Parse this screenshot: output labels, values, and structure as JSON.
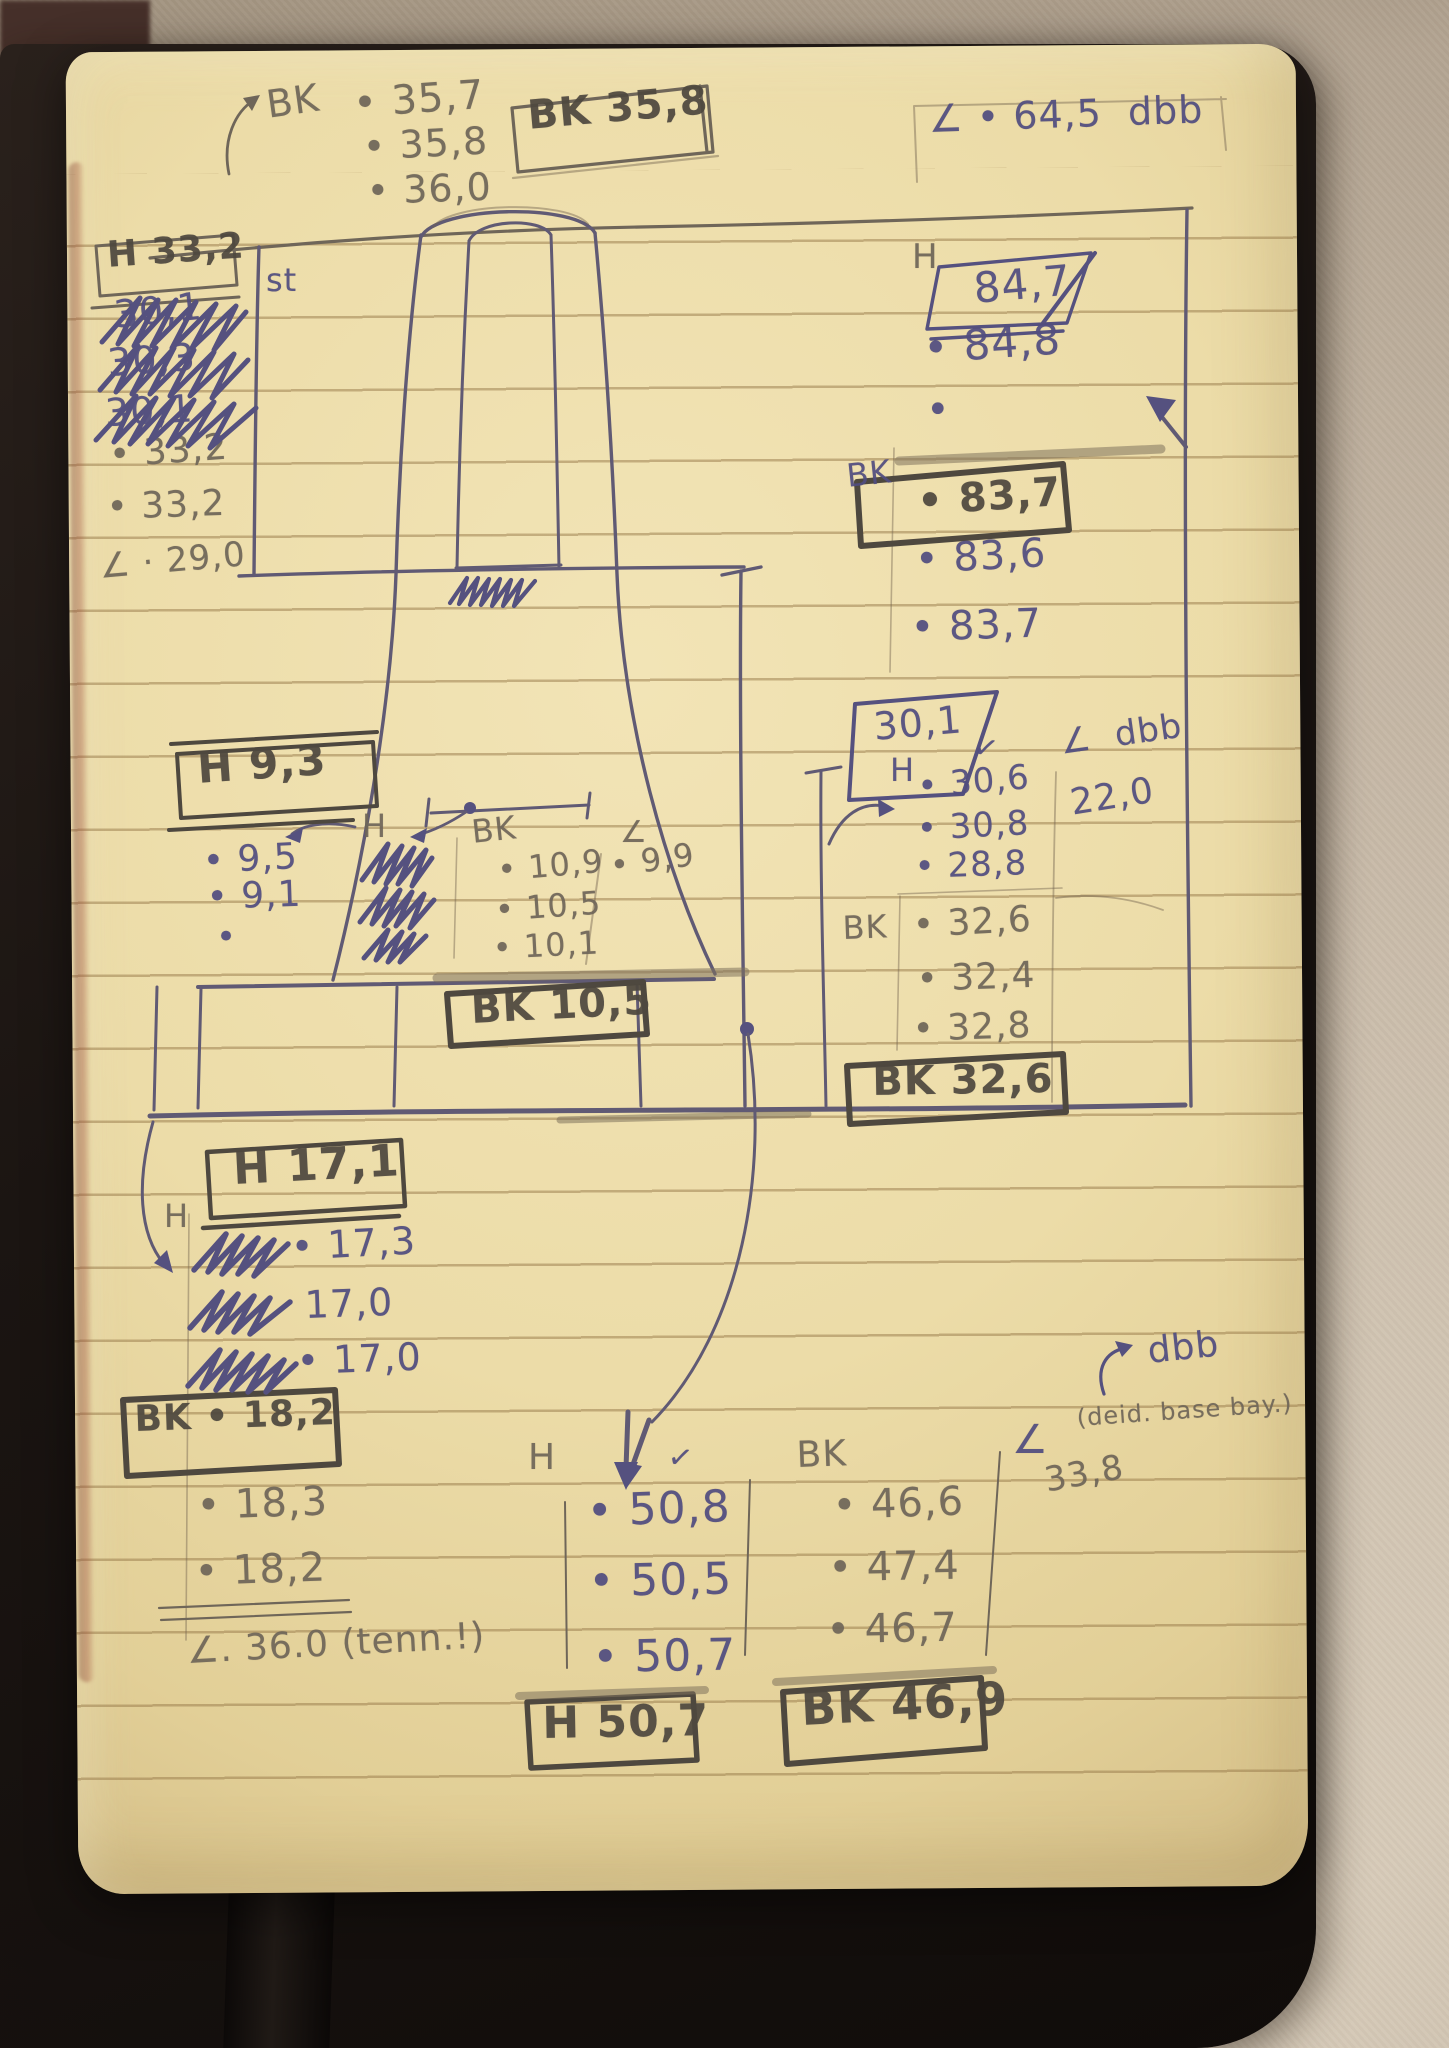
{
  "meta": {
    "description": "Photograph of a notebook page with hand-written field measurements (H and BK value series, angle readings) around a sketched monument / obelisk"
  },
  "colors": {
    "page_paper": "#ecddab",
    "ruled_line": "#9b7c4a",
    "pencil": "#6f6659",
    "ink_blue": "#514d80",
    "heavy_pencil": "#4e483f",
    "cover": "#1b1512",
    "wall": "#c3b5a2",
    "ribbon": "#15100d"
  },
  "annotations": [
    {
      "name": "bk-top-label",
      "text": "BK",
      "x": 264,
      "y": 86,
      "s": 38,
      "c": "p",
      "r": -8
    },
    {
      "name": "bk-top-value-1",
      "text": "• 35,7",
      "x": 352,
      "y": 84,
      "s": 40,
      "c": "p",
      "r": -4
    },
    {
      "name": "bk-top-value-2",
      "text": "• 35,8",
      "x": 362,
      "y": 128,
      "s": 38,
      "c": "p",
      "r": -3
    },
    {
      "name": "bk-top-value-3",
      "text": "• 36,0",
      "x": 366,
      "y": 172,
      "s": 38,
      "c": "p",
      "r": -2
    },
    {
      "name": "bk-top-result-box",
      "text": "BK 35,8",
      "x": 526,
      "y": 96,
      "s": 40,
      "c": "h",
      "r": -5
    },
    {
      "name": "angle-top-right",
      "text": "∠ • 64,5  dbb",
      "x": 928,
      "y": 100,
      "s": 38,
      "c": "i",
      "r": -2
    },
    {
      "name": "h-left-result-box",
      "text": "H 33,2",
      "x": 106,
      "y": 238,
      "s": 36,
      "c": "h",
      "r": -4
    },
    {
      "name": "h-left-struck-1",
      "text": "30,1",
      "x": 112,
      "y": 296,
      "s": 38,
      "c": "i",
      "r": -6
    },
    {
      "name": "h-left-struck-2",
      "text": "30,3",
      "x": 106,
      "y": 344,
      "s": 38,
      "c": "i",
      "r": -4
    },
    {
      "name": "h-left-struck-3",
      "text": "30,1",
      "x": 104,
      "y": 394,
      "s": 38,
      "c": "i",
      "r": -3
    },
    {
      "name": "h-left-value-1",
      "text": "• 33,2",
      "x": 108,
      "y": 438,
      "s": 36,
      "c": "p",
      "r": -4
    },
    {
      "name": "h-left-value-2",
      "text": "• 33,2",
      "x": 106,
      "y": 490,
      "s": 36,
      "c": "p",
      "r": -2
    },
    {
      "name": "angle-left",
      "text": "∠ · 29,0",
      "x": 98,
      "y": 550,
      "s": 34,
      "c": "p",
      "r": -5
    },
    {
      "name": "st-label",
      "text": "st",
      "x": 266,
      "y": 264,
      "s": 32,
      "c": "i",
      "r": 0
    },
    {
      "name": "h-right-label",
      "text": "H",
      "x": 912,
      "y": 240,
      "s": 34,
      "c": "p",
      "r": 0
    },
    {
      "name": "h-right-result",
      "text": "84,7",
      "x": 972,
      "y": 268,
      "s": 42,
      "c": "i",
      "r": -5
    },
    {
      "name": "h-right-value-1",
      "text": "• 84,8",
      "x": 922,
      "y": 328,
      "s": 42,
      "c": "i",
      "r": -4
    },
    {
      "name": "h-right-dot",
      "text": "•",
      "x": 926,
      "y": 390,
      "s": 40,
      "c": "i",
      "r": 0
    },
    {
      "name": "bk-right-label",
      "text": "BK",
      "x": 845,
      "y": 460,
      "s": 32,
      "c": "i",
      "r": -6
    },
    {
      "name": "bk-right-result",
      "text": "• 83,7",
      "x": 916,
      "y": 482,
      "s": 40,
      "c": "h",
      "r": -4
    },
    {
      "name": "bk-right-value-1",
      "text": "• 83,6",
      "x": 914,
      "y": 540,
      "s": 40,
      "c": "i",
      "r": -3
    },
    {
      "name": "bk-right-value-2",
      "text": "• 83,7",
      "x": 910,
      "y": 608,
      "s": 40,
      "c": "i",
      "r": -2
    },
    {
      "name": "h-mid-result",
      "text": "30,1",
      "x": 872,
      "y": 708,
      "s": 38,
      "c": "i",
      "r": -5
    },
    {
      "name": "h-mid-label",
      "text": "H",
      "x": 890,
      "y": 754,
      "s": 32,
      "c": "i",
      "r": 0
    },
    {
      "name": "h-mid-check",
      "text": "✓",
      "x": 976,
      "y": 732,
      "s": 30,
      "c": "i",
      "r": 10
    },
    {
      "name": "h-mid-value-1",
      "text": "• 30,6",
      "x": 916,
      "y": 770,
      "s": 34,
      "c": "i",
      "r": -5
    },
    {
      "name": "h-mid-value-2",
      "text": "• 30,8",
      "x": 916,
      "y": 812,
      "s": 34,
      "c": "i",
      "r": -3
    },
    {
      "name": "h-mid-value-3",
      "text": "• 28,8",
      "x": 914,
      "y": 850,
      "s": 34,
      "c": "i",
      "r": -2
    },
    {
      "name": "angle-mid-label",
      "text": "∠  dbb",
      "x": 1058,
      "y": 726,
      "s": 34,
      "c": "i",
      "r": -8
    },
    {
      "name": "angle-mid-value",
      "text": "22,0",
      "x": 1068,
      "y": 786,
      "s": 36,
      "c": "i",
      "r": -9
    },
    {
      "name": "bk-mid-label",
      "text": "BK",
      "x": 842,
      "y": 912,
      "s": 32,
      "c": "p",
      "r": -2
    },
    {
      "name": "bk-mid-value-1",
      "text": "• 32,6",
      "x": 912,
      "y": 908,
      "s": 36,
      "c": "p",
      "r": -3
    },
    {
      "name": "bk-mid-value-2",
      "text": "• 32,4",
      "x": 916,
      "y": 962,
      "s": 36,
      "c": "p",
      "r": -2
    },
    {
      "name": "bk-mid-value-3",
      "text": "• 32,8",
      "x": 912,
      "y": 1012,
      "s": 36,
      "c": "p",
      "r": -2
    },
    {
      "name": "bk-mid-result-box",
      "text": "BK 32,6",
      "x": 872,
      "y": 1062,
      "s": 40,
      "c": "h",
      "r": -1
    },
    {
      "name": "h-small-result-box",
      "text": "H 9,3",
      "x": 196,
      "y": 748,
      "s": 42,
      "c": "h",
      "r": -4
    },
    {
      "name": "h-small-label",
      "text": "H",
      "x": 362,
      "y": 810,
      "s": 32,
      "c": "p",
      "r": 0
    },
    {
      "name": "h-small-value-1",
      "text": "• 9,5",
      "x": 202,
      "y": 844,
      "s": 36,
      "c": "i",
      "r": -3
    },
    {
      "name": "h-small-value-2",
      "text": "• 9,1",
      "x": 206,
      "y": 880,
      "s": 36,
      "c": "i",
      "r": -2
    },
    {
      "name": "h-small-dot",
      "text": "•",
      "x": 216,
      "y": 920,
      "s": 34,
      "c": "i",
      "r": 0
    },
    {
      "name": "bk-small-label",
      "text": "BK",
      "x": 470,
      "y": 816,
      "s": 32,
      "c": "p",
      "r": -6
    },
    {
      "name": "bk-small-value-1",
      "text": "• 10,9",
      "x": 496,
      "y": 854,
      "s": 32,
      "c": "p",
      "r": -5
    },
    {
      "name": "bk-small-value-2",
      "text": "• 10,5",
      "x": 494,
      "y": 894,
      "s": 32,
      "c": "p",
      "r": -4
    },
    {
      "name": "bk-small-value-3",
      "text": "• 10,1",
      "x": 492,
      "y": 932,
      "s": 32,
      "c": "p",
      "r": -3
    },
    {
      "name": "angle-small-label",
      "text": "∠",
      "x": 620,
      "y": 818,
      "s": 30,
      "c": "p",
      "r": 0
    },
    {
      "name": "angle-small-value",
      "text": "• 9,9",
      "x": 608,
      "y": 850,
      "s": 32,
      "c": "p",
      "r": -8
    },
    {
      "name": "bk-small-result-box",
      "text": "BK 10,5",
      "x": 470,
      "y": 990,
      "s": 40,
      "c": "h",
      "r": -3
    },
    {
      "name": "h-17-result-box",
      "text": "H 17,1",
      "x": 232,
      "y": 1148,
      "s": 44,
      "c": "h",
      "r": -3
    },
    {
      "name": "h-17-label",
      "text": "H",
      "x": 164,
      "y": 1200,
      "s": 32,
      "c": "p",
      "r": 0
    },
    {
      "name": "h-17-value-1",
      "text": "• 17,3",
      "x": 290,
      "y": 1228,
      "s": 38,
      "c": "i",
      "r": -3
    },
    {
      "name": "h-17-value-2",
      "text": "17,0",
      "x": 304,
      "y": 1286,
      "s": 38,
      "c": "i",
      "r": -2
    },
    {
      "name": "h-17-value-3",
      "text": "• 17,0",
      "x": 296,
      "y": 1342,
      "s": 38,
      "c": "i",
      "r": -2
    },
    {
      "name": "bk-18-result-box",
      "text": "BK • 18,2",
      "x": 134,
      "y": 1402,
      "s": 36,
      "c": "h",
      "r": -2
    },
    {
      "name": "bk-18-value-1",
      "text": "• 18,3",
      "x": 196,
      "y": 1486,
      "s": 40,
      "c": "p",
      "r": -2
    },
    {
      "name": "bk-18-value-2",
      "text": "• 18,2",
      "x": 194,
      "y": 1552,
      "s": 40,
      "c": "p",
      "r": -2
    },
    {
      "name": "angle-18",
      "text": "∠. 36.0 (tenn.!)",
      "x": 186,
      "y": 1634,
      "s": 36,
      "c": "p",
      "r": -3
    },
    {
      "name": "h-50-label",
      "text": "H",
      "x": 528,
      "y": 1440,
      "s": 36,
      "c": "p",
      "r": 0
    },
    {
      "name": "h-50-check",
      "text": "✓",
      "x": 670,
      "y": 1442,
      "s": 30,
      "c": "i",
      "r": 8
    },
    {
      "name": "h-50-value-1",
      "text": "• 50,8",
      "x": 586,
      "y": 1490,
      "s": 44,
      "c": "i",
      "r": -2
    },
    {
      "name": "h-50-value-2",
      "text": "• 50,5",
      "x": 588,
      "y": 1560,
      "s": 44,
      "c": "i",
      "r": -1
    },
    {
      "name": "h-50-value-3",
      "text": "• 50,7",
      "x": 592,
      "y": 1636,
      "s": 44,
      "c": "i",
      "r": -1
    },
    {
      "name": "h-50-result-box",
      "text": "H 50,7",
      "x": 542,
      "y": 1702,
      "s": 44,
      "c": "h",
      "r": -1
    },
    {
      "name": "bk-46-label",
      "text": "BK",
      "x": 796,
      "y": 1438,
      "s": 36,
      "c": "p",
      "r": -2
    },
    {
      "name": "bk-46-value-1",
      "text": "• 46,6",
      "x": 832,
      "y": 1486,
      "s": 40,
      "c": "p",
      "r": -2
    },
    {
      "name": "bk-46-value-2",
      "text": "• 47,4",
      "x": 828,
      "y": 1548,
      "s": 40,
      "c": "p",
      "r": -1
    },
    {
      "name": "bk-46-value-3",
      "text": "• 46,7",
      "x": 826,
      "y": 1610,
      "s": 40,
      "c": "p",
      "r": -1
    },
    {
      "name": "bk-46-result-box",
      "text": "BK 46,9",
      "x": 800,
      "y": 1686,
      "s": 46,
      "c": "h",
      "r": -3
    },
    {
      "name": "dbb-note",
      "text": "dbb",
      "x": 1146,
      "y": 1334,
      "s": 36,
      "c": "i",
      "r": -6
    },
    {
      "name": "dbb-sub-note",
      "text": "(deid. base bay.)",
      "x": 1076,
      "y": 1406,
      "s": 24,
      "c": "p",
      "r": -4
    },
    {
      "name": "angle-46-symbol",
      "text": "∠",
      "x": 1012,
      "y": 1420,
      "s": 40,
      "c": "i",
      "r": 0
    },
    {
      "name": "angle-46-value",
      "text": "33,8",
      "x": 1042,
      "y": 1464,
      "s": 34,
      "c": "p",
      "r": -10
    }
  ]
}
